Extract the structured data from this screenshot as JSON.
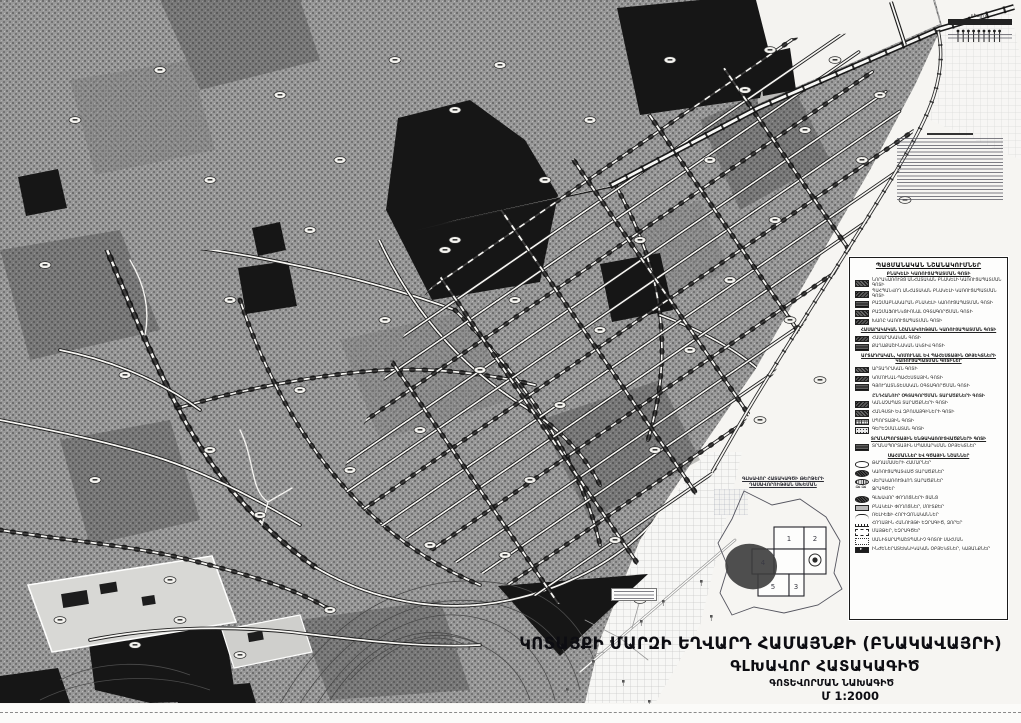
{
  "map": {
    "title_line1": "ԿՈՏԱՅՔԻ ՄԱՐԶԻ ԵՂՎԱՐԴ ՀԱՄԱՅՆՔԻ (ԲՆԱԿԱՎԱՅՐԻ)",
    "title_line2": "ԳԼԽԱՎՈՐ ՀԱՏԱԿԱԳԻԾ",
    "title_line3": "ԳՈՏԵՎՈՐՄԱՆ ՆԱԽԱԳԻԾ",
    "scale": "Մ 1:2000",
    "corner_label_small": "դեպի ք.",
    "corner_label_dest": "ՆՈՐ ՀԱՃՆ"
  },
  "legend": {
    "title": "ՊԱՅՄԱՆԱԿԱՆ ՆՇԱՆԱԿՈՒՄՆԵՐ",
    "subtitle": "ԲՆԱԿԵԼԻ ԿԱՌՈՒՑԱՊԱՏՄԱՆ ԳՈՏԻ",
    "items": [
      {
        "t": "r",
        "s": "s-dk1",
        "label": "ՆՈՐԱԿԱՌՈՒՅՑ ԱՆՀԱՏԱԿԱՆ ԲՆԱԿԵԼԻ ԿԱՌՈՒՑԱՊԱՏՄԱՆ ԳՈՏԻ"
      },
      {
        "t": "r",
        "s": "s-dk2",
        "label": "ՊԱՀՊԱՆՎՈՂ ԱՆՀԱՏԱԿԱՆ ԲՆԱԿԵԼԻ ԿԱՌՈՒՑԱՊԱՏՄԱՆ ԳՈՏԻ"
      },
      {
        "t": "r",
        "s": "s-dk3",
        "label": "ԲԱԶՄԱԲՆԱԿԱՐԱՆ ԲՆԱԿԵԼԻ ԿԱՌՈՒՑԱՊԱՏՄԱՆ ԳՈՏԻ"
      },
      {
        "t": "r",
        "s": "s-dk1",
        "label": "ԲԱԶՄԱՖՈՒՆԿՑԻՈՆԱԼ ՕԳՏԱԳՈՐԾՄԱՆ ԳՈՏԻ"
      },
      {
        "t": "r",
        "s": "s-dk2",
        "label": "ԽԱՌԸ ԿԱՌՈՒՑԱՊԱՏՄԱՆ ԳՈՏԻ"
      },
      {
        "t": "h",
        "label": "ՀԱՍԱՐԱԿԱԿԱՆ ՆՇԱՆԱԿՈՒԹՅԱՆ ԿԱՌՈՒՑԱՊԱՏՄԱՆ ԳՈՏԻ"
      },
      {
        "t": "r",
        "s": "s-dk2",
        "label": "ՀԱՍԱՐԱԿԱԿԱՆ ԳՈՏԻ"
      },
      {
        "t": "r",
        "s": "s-dk3",
        "label": "ՔԱՂԱՔԱՇԻՆԱԿԱՆ ԱԿՏԻՎ ԳՈՏԻ"
      },
      {
        "t": "h",
        "label": "ԱՐՏԱԴՐԱԿԱՆ, ԿՈՄՈՒՆԱԼ ԵՎ ՊԱՀԵՍՏԱՅԻՆ ՕԲՅԵԿՏՆԵՐԻ ԿԱՌՈՒՑԱՊԱՏՄԱՆ ԳՈՏԻՆԵՐ"
      },
      {
        "t": "r",
        "s": "s-dk1",
        "label": "ԱՐՏԱԴՐԱԿԱՆ ԳՈՏԻ"
      },
      {
        "t": "r",
        "s": "s-dk2",
        "label": "ԿՈՄՈՒՆԱԼ-ՊԱՀԵՍՏԱՅԻՆ ԳՈՏԻ"
      },
      {
        "t": "r",
        "s": "s-dk3",
        "label": "ԳՅՈՒՂԱՏՆՏԵՍԱԿԱՆ ՕԳՏԱԳՈՐԾՄԱՆ ԳՈՏԻ"
      },
      {
        "t": "hp",
        "label": "ԸՆԴՀԱՆՈՒՐ ՕԳՏԱԳՈՐԾՄԱՆ ՏԱՐԱԾՔՆԵՐԻ ԳՈՏԻ"
      },
      {
        "t": "r",
        "s": "s-dk2",
        "label": "ԿԱՆԱՉԱՊԱՏ ՏԱՐԱԾՔՆԵՐԻ ԳՈՏԻ"
      },
      {
        "t": "r",
        "s": "s-dk1",
        "label": "ՀԱՆԳՍՏԻ ԵՎ ԶԲՈՍԱՅԳԻՆԵՐԻ ԳՈՏԻ"
      },
      {
        "t": "r",
        "s": "s-grid",
        "label": "ՍՊՈՐՏԱՅԻՆ ԳՈՏԻ"
      },
      {
        "t": "r",
        "s": "s-dots",
        "label": "ԳԵՐԵԶՄԱՆԱՏԱՆ ԳՈՏԻ"
      },
      {
        "t": "h",
        "label": "ՏՐԱՆՍՊՈՐՏԱՅԻՆ ԵՆԹԱԿԱՌՈՒՑՎԱԾՔՆԵՐԻ ԳՈՏԻ"
      },
      {
        "t": "r",
        "s": "s-dk3",
        "label": "ՏՐԱՆՍՊՈՐՏԱՅԻՆ ՍՊԱՍԱՐԿՄԱՆ ՕԲՅԵԿՏՆԵՐ"
      },
      {
        "t": "h",
        "label": "ՍԱՀՄԱՆՆԵՐ ԵՎ ԳԾԱՅԻՆ ՆՇԱՆՆԵՐ"
      },
      {
        "t": "r",
        "s": "s-oval",
        "label": "ԹԱՂԱՄԱՍԵՐԻ ՀԱՄԱՐՆԵՐ"
      },
      {
        "t": "r",
        "s": "s-dkov",
        "label": "ԿԱՌՈՒՑԱՊԱՏՎԱԾ ՏԱՐԱԾՔՆԵՐ"
      },
      {
        "t": "r",
        "s": "s-hatchov",
        "label": "ՎԵՐԱԿԱՌՈՒՑՎՈՂ ՏԱՐԱԾՔՆԵՐ"
      },
      {
        "t": "r",
        "s": "s-wave",
        "label": "ՋՐԱԳԾԵՐ"
      },
      {
        "t": "r",
        "s": "s-dkov",
        "label": "ԳԼԽԱՎՈՐ ՓՈՂՈՑՆԵՐԻ ՑԱՆՑ"
      },
      {
        "t": "r",
        "s": "s-gray",
        "label": "ԲՆԱԿԵԼԻ ՓՈՂՈՑՆԵՐ, ՄՈՒՏՔԵՐ"
      },
      {
        "t": "r",
        "s": "s-curve",
        "label": "ՌԵԼԻԵՖԻ ՀՈՐԻԶՈՆԱԿԱՆՆԵՐ"
      },
      {
        "t": "r",
        "s": "s-curvet",
        "label": "ՀՈՂԱՅԻՆ ՀԱՆՈՒՅԹԻ ԵԶՐԱԳԻԾ, ՁՈՐԵՐ"
      },
      {
        "t": "r",
        "s": "s-dash",
        "label": "ՄԱՅԹԵՐ, ԵԶՐԱԳԾԵՐ"
      },
      {
        "t": "r",
        "s": "s-dotbox",
        "label": "ՍԱՆԻՏԱՐԱՊԱՇՏՊԱՆԻՉ ԳՈՏՈՒ ՍԱՀՄԱՆ"
      },
      {
        "t": "r",
        "s": "s-flag",
        "label": "ԻՆԺԵՆԵՐԱՏԵԽՆԻԿԱԿԱՆ ՕԲՅԵԿՏՆԵՐ, ԿԱՅԱՆՔՆԵՐ"
      }
    ]
  },
  "inset": {
    "title_line1": "ԳԼԽԱՎՈՐ ՀԱՏԱԿԱԳԾԻ ԹԵՐԹԵՐԻ",
    "title_line2": "ԴԱՍԱՎՈՐՈՒԹՅԱՆ ՍԽԵՄԱՆ",
    "sheets": [
      "1",
      "2",
      "3",
      "4",
      "5"
    ]
  },
  "colors": {
    "urban_gray": "#909090",
    "dark_zone": "#1c1c1c",
    "road_white": "#f8f8f6",
    "paper": "#fbfbf9",
    "ink": "#111111"
  }
}
